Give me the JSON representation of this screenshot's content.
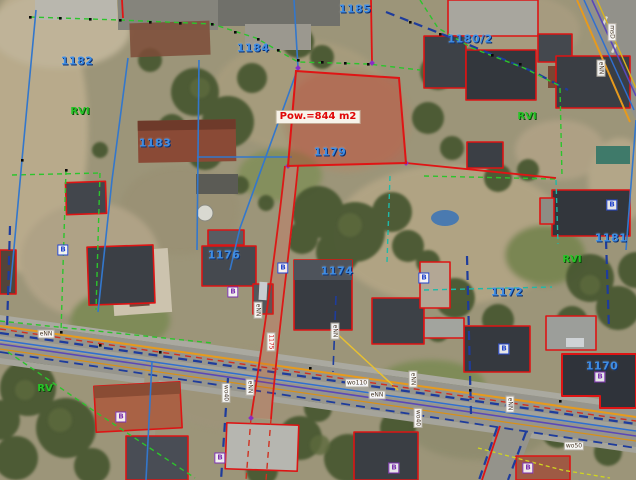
{
  "map": {
    "selected_parcel": {
      "number": "1179",
      "area_label": "Pow.=844 m2"
    },
    "parcel_numbers": [
      {
        "text": "1182",
        "x": 77,
        "y": 61
      },
      {
        "text": "1183",
        "x": 155,
        "y": 143
      },
      {
        "text": "1184",
        "x": 253,
        "y": 48
      },
      {
        "text": "1185",
        "x": 355,
        "y": 9
      },
      {
        "text": "1180/2",
        "x": 470,
        "y": 39
      },
      {
        "text": "1179",
        "x": 330,
        "y": 152,
        "selected": true
      },
      {
        "text": "1176",
        "x": 224,
        "y": 255
      },
      {
        "text": "1174",
        "x": 337,
        "y": 271
      },
      {
        "text": "1172",
        "x": 507,
        "y": 292
      },
      {
        "text": "1181",
        "x": 611,
        "y": 238
      },
      {
        "text": "1170",
        "x": 602,
        "y": 366
      }
    ],
    "soil_class_labels": [
      {
        "text": "RVI",
        "x": 80,
        "y": 112
      },
      {
        "text": "RVI",
        "x": 527,
        "y": 117
      },
      {
        "text": "RVI",
        "x": 572,
        "y": 260
      },
      {
        "text": "RV",
        "x": 45,
        "y": 389
      }
    ],
    "building_labels": [
      {
        "text": "B",
        "x": 63,
        "y": 250,
        "style": "blue"
      },
      {
        "text": "B",
        "x": 283,
        "y": 268,
        "style": "blue"
      },
      {
        "text": "B",
        "x": 233,
        "y": 292,
        "style": "purple"
      },
      {
        "text": "B",
        "x": 424,
        "y": 278,
        "style": "blue"
      },
      {
        "text": "B",
        "x": 504,
        "y": 349,
        "style": "blue"
      },
      {
        "text": "B",
        "x": 612,
        "y": 205,
        "style": "blue"
      },
      {
        "text": "B",
        "x": 600,
        "y": 377,
        "style": "purple"
      },
      {
        "text": "B",
        "x": 121,
        "y": 417,
        "style": "purple"
      },
      {
        "text": "B",
        "x": 220,
        "y": 458,
        "style": "purple"
      },
      {
        "text": "B",
        "x": 394,
        "y": 468,
        "style": "purple"
      },
      {
        "text": "B",
        "x": 528,
        "y": 468,
        "style": "purple"
      }
    ],
    "utility_labels": [
      {
        "text": "eNN",
        "x": 258,
        "y": 310,
        "vertical": true
      },
      {
        "text": "1175",
        "x": 271,
        "y": 342,
        "vertical": true,
        "red": true
      },
      {
        "text": "eNN",
        "x": 250,
        "y": 387,
        "vertical": true
      },
      {
        "text": "wo40",
        "x": 226,
        "y": 393,
        "vertical": true
      },
      {
        "text": "eNN",
        "x": 335,
        "y": 331,
        "vertical": true
      },
      {
        "text": "wo110",
        "x": 357,
        "y": 383
      },
      {
        "text": "eNN",
        "x": 377,
        "y": 395
      },
      {
        "text": "eNN",
        "x": 413,
        "y": 379,
        "vertical": true
      },
      {
        "text": "wo40",
        "x": 418,
        "y": 418,
        "vertical": true
      },
      {
        "text": "msD",
        "x": 612,
        "y": 32,
        "vertical": true
      },
      {
        "text": "eNN",
        "x": 601,
        "y": 68,
        "vertical": true
      },
      {
        "text": "eNN",
        "x": 46,
        "y": 334
      },
      {
        "text": "eNN",
        "x": 510,
        "y": 404,
        "vertical": true
      },
      {
        "text": "wo50",
        "x": 574,
        "y": 446
      }
    ],
    "colors": {
      "selected_fill": "rgba(195,55,40,0.35)",
      "selected_outline": "#e01414",
      "parcel_number_blue": "#3f8de4",
      "soil_green": "#27c427",
      "boundary_blue": "#3377cc",
      "boundary_green_dashed": "#2cc42c",
      "boundary_navy_dashed": "#1e3c9c",
      "utility_orange": "#e79a1c"
    }
  }
}
